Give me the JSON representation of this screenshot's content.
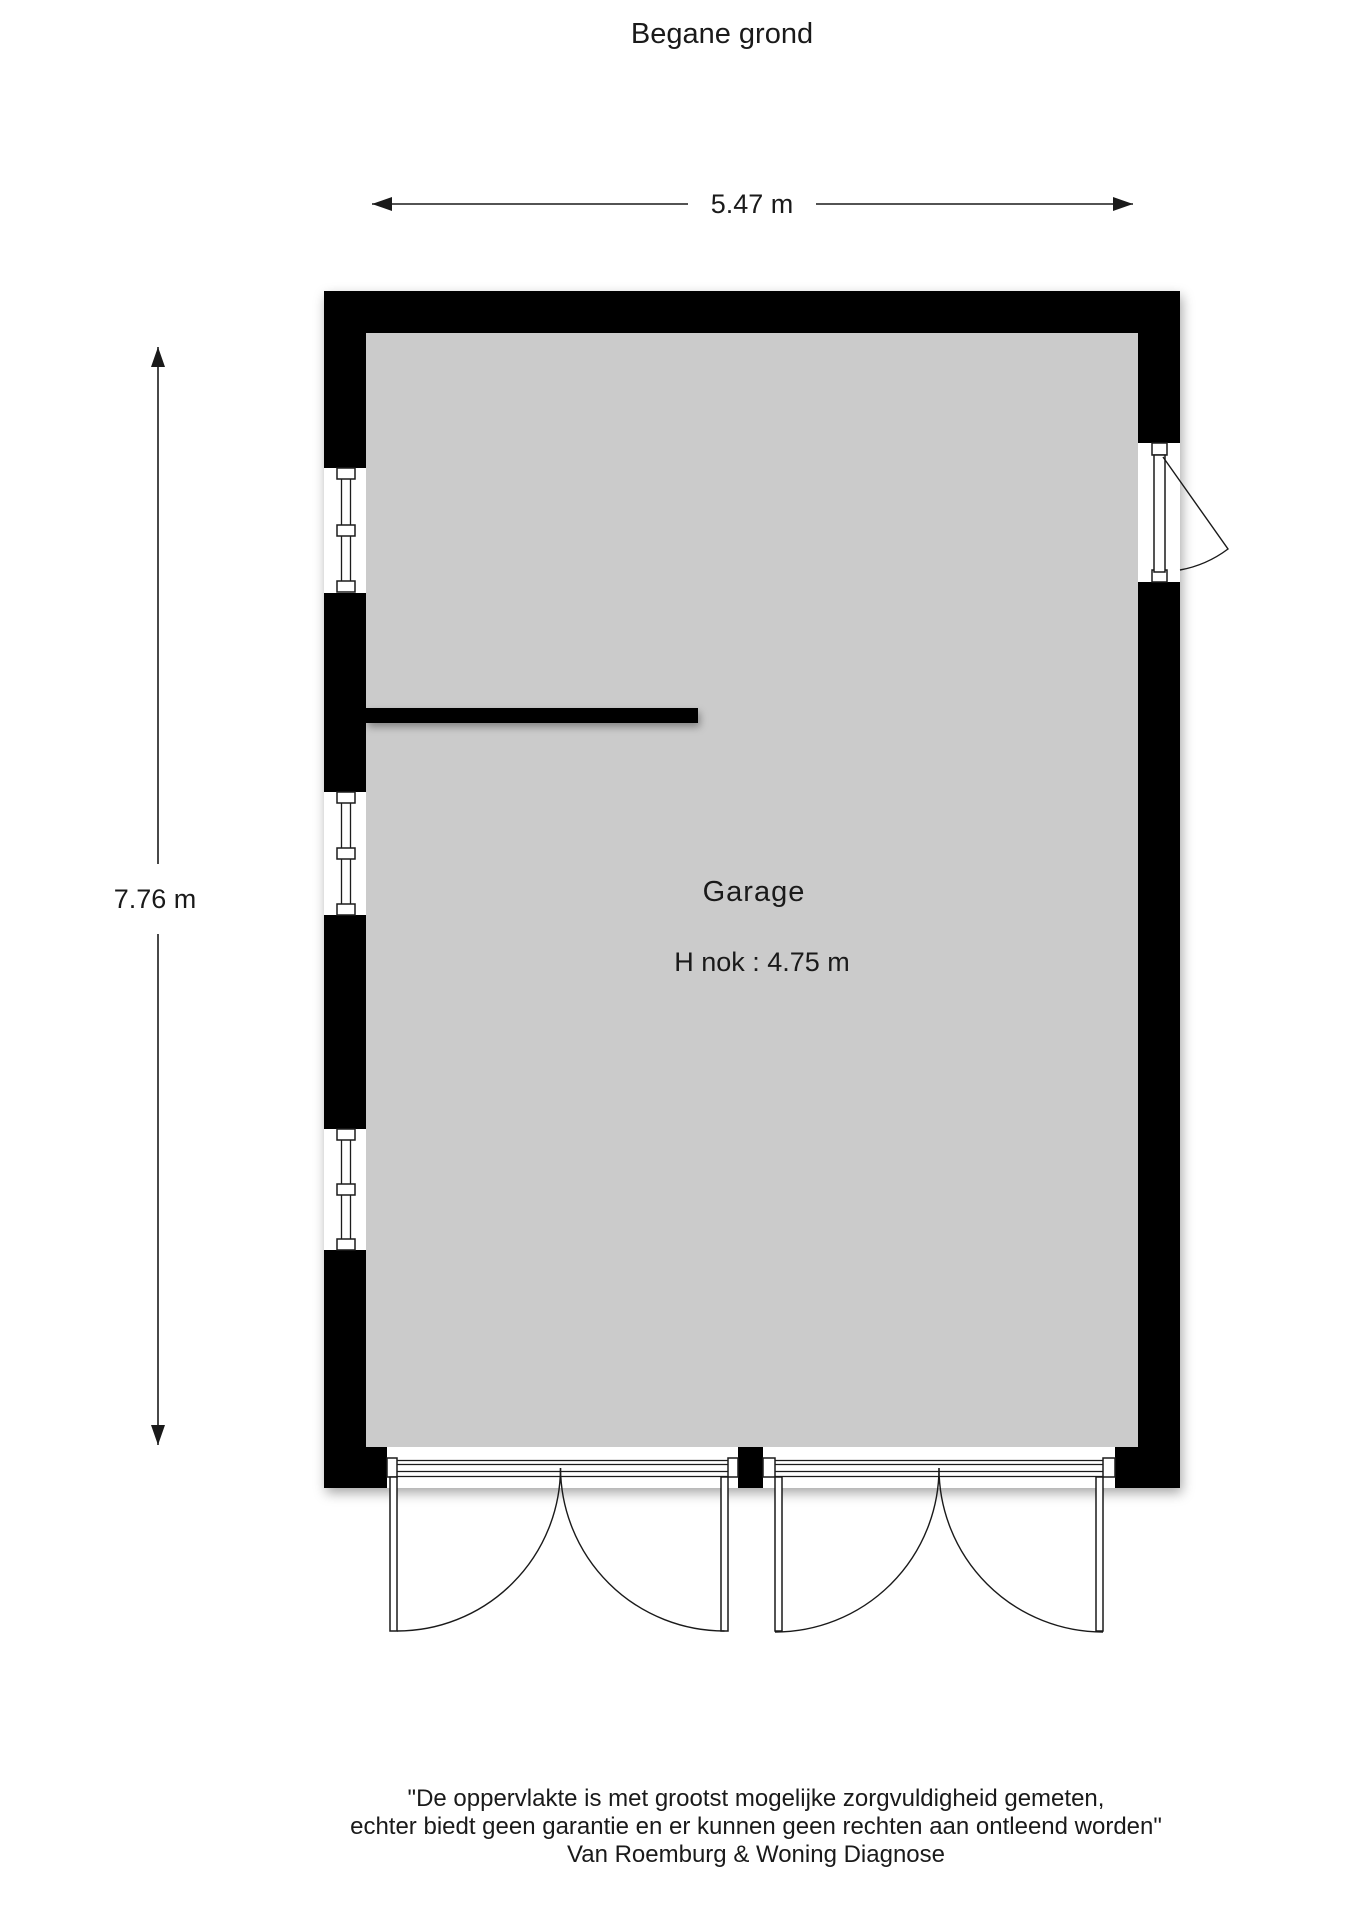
{
  "title": "Begane grond",
  "room": {
    "name": "Garage",
    "height_note": "H nok : 4.75 m"
  },
  "dimensions": {
    "width_label": "5.47 m",
    "height_label": "7.76 m"
  },
  "features": {
    "left_wall_windows": 3,
    "right_wall_doors": 1,
    "bottom_garage_door_openings": 2,
    "door_leaves_per_opening": 2
  },
  "footer": {
    "lines": [
      "\"De oppervlakte is met grootst mogelijke zorgvuldigheid gemeten,",
      "echter biedt geen garantie en er kunnen geen rechten aan ontleend worden\"",
      "Van Roemburg & Woning Diagnose"
    ]
  },
  "colors": {
    "wall": "#000000",
    "floor": "#cbcbcb",
    "line": "#1a1a1a",
    "background": "#ffffff"
  }
}
